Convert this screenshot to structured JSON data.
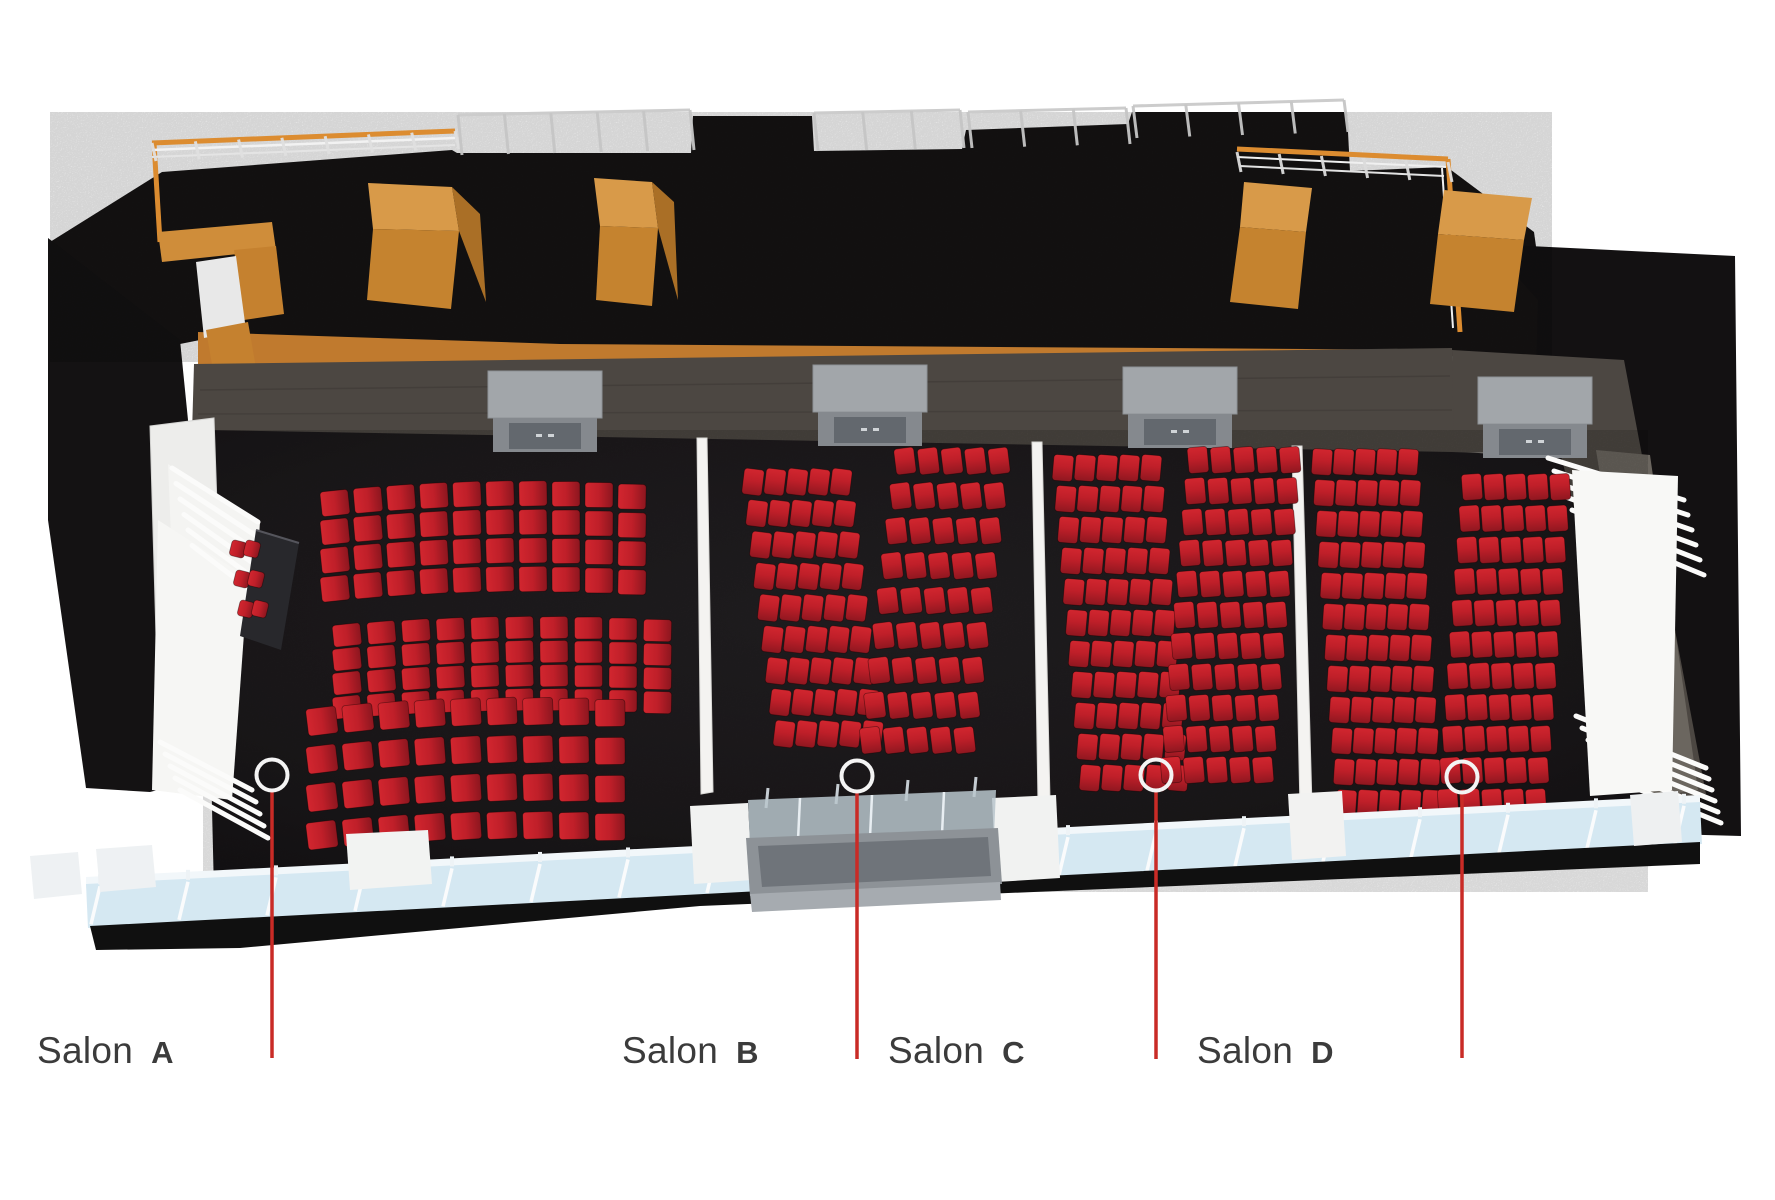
{
  "scene": {
    "name": "Ballroom floor plan - aerial 3D rendering",
    "description": "Top view rendering of a conference ballroom divided into four salons with red theater-style seating, backstage corridor with wooden crates, glass curtain wall entrance, and callout markers for each salon",
    "background": "#ffffff"
  },
  "colors": {
    "chair_red": "#bf1f29",
    "chair_red_light": "#d2262f",
    "chair_red_dark": "#8f1720",
    "carpet": "#1d1a1c",
    "backstage_black": "#161414",
    "wood_top": "#d89a49",
    "wood_front": "#c5832f",
    "wood_side": "#aa6f26",
    "rail_orange": "#dc8c30",
    "wall_band": "#4c4742",
    "door_roof": "#a2a6aa",
    "door_face": "#85898e",
    "door_inner": "#63686e",
    "partition_white": "#f4f3f1",
    "glass_blue": "#d5e8f2",
    "leader_red": "#c92b26",
    "marker_ring": "#f4f4f4",
    "label_text": "#3b3b3b"
  },
  "salons": [
    {
      "id": "A",
      "word": "Salon",
      "letter": "A",
      "label_x": 37,
      "label_y": 1030,
      "marker_x": 272,
      "marker_y": 775,
      "line_end_y": 1058
    },
    {
      "id": "B",
      "word": "Salon",
      "letter": "B",
      "label_x": 622,
      "label_y": 1030,
      "marker_x": 857,
      "marker_y": 776,
      "line_end_y": 1059
    },
    {
      "id": "C",
      "word": "Salon",
      "letter": "C",
      "label_x": 888,
      "label_y": 1030,
      "marker_x": 1156,
      "marker_y": 775,
      "line_end_y": 1059
    },
    {
      "id": "D",
      "word": "Salon",
      "letter": "D",
      "label_x": 1197,
      "label_y": 1030,
      "marker_x": 1462,
      "marker_y": 777,
      "line_end_y": 1058
    }
  ],
  "doors": [
    {
      "x": 545,
      "y": 418
    },
    {
      "x": 870,
      "y": 412
    },
    {
      "x": 1180,
      "y": 414
    },
    {
      "x": 1535,
      "y": 424
    }
  ],
  "seating_blocks": [
    {
      "name": "salon-a-seats-front",
      "x": 335,
      "y": 497,
      "cols": 10,
      "rows": 4,
      "dx": 33,
      "dy": 28.5,
      "w": 28,
      "h": 25,
      "tilt": -6,
      "fan": 0.8,
      "arc": 6,
      "slope": -0.7,
      "grad": "h"
    },
    {
      "name": "salon-a-seats-middle",
      "x": 347,
      "y": 630,
      "cols": 10,
      "rows": 4,
      "dx": 34.5,
      "dy": 24,
      "w": 28,
      "h": 22,
      "tilt": -6,
      "fan": 0.8,
      "arc": 5,
      "slope": -0.5,
      "grad": "h"
    },
    {
      "name": "salon-a-seats-rear",
      "x": 322,
      "y": 716,
      "cols": 9,
      "rows": 4,
      "dx": 36,
      "dy": 38,
      "w": 30,
      "h": 27,
      "tilt": -7,
      "fan": 0.8,
      "arc": 5,
      "slope": -1.0,
      "grad": "h"
    },
    {
      "name": "salon-b-seats-left",
      "x": 753,
      "y": 482,
      "cols": 5,
      "rows": 9,
      "dx": 22,
      "dy": 31.5,
      "w": 20,
      "h": 26,
      "tilt": 7,
      "drift": 3.9,
      "grad": "v"
    },
    {
      "name": "salon-b-seats-right",
      "x": 905,
      "y": 461,
      "cols": 5,
      "rows": 9,
      "dx": 23.5,
      "dy": 34.9,
      "w": 20,
      "h": 26,
      "tilt": -7,
      "drift": -4.3,
      "grad": "v"
    },
    {
      "name": "salon-c-seats-left",
      "x": 1063,
      "y": 468,
      "cols": 5,
      "rows": 11,
      "dx": 22,
      "dy": 31,
      "w": 20,
      "h": 26,
      "tilt": 5,
      "drift": 2.7,
      "grad": "v"
    },
    {
      "name": "salon-c-seats-right",
      "x": 1198,
      "y": 460,
      "cols": 5,
      "rows": 11,
      "dx": 23,
      "dy": 31,
      "w": 20,
      "h": 26,
      "tilt": -5,
      "drift": -2.7,
      "grad": "v"
    },
    {
      "name": "salon-d-seats-left",
      "x": 1322,
      "y": 462,
      "cols": 5,
      "rows": 12,
      "dx": 21.5,
      "dy": 31,
      "w": 20,
      "h": 26,
      "tilt": 4,
      "drift": 2.2,
      "grad": "v"
    },
    {
      "name": "salon-d-seats-right",
      "x": 1472,
      "y": 487,
      "cols": 5,
      "rows": 11,
      "dx": 22,
      "dy": 31.5,
      "w": 20,
      "h": 26,
      "tilt": -4,
      "drift": -2.4,
      "grad": "v"
    },
    {
      "name": "head-table-chairs",
      "x": 238,
      "y": 549,
      "cols": 2,
      "rows": 3,
      "dx": 14,
      "dy": 30,
      "w": 15,
      "h": 16,
      "tilt": 14,
      "drift": 4,
      "grad": "h"
    }
  ],
  "glass_wall": {
    "x1": 86,
    "y1": 884,
    "x2": 1700,
    "y2": 802,
    "mullion_count": 19,
    "mullion_spacing": 88
  }
}
